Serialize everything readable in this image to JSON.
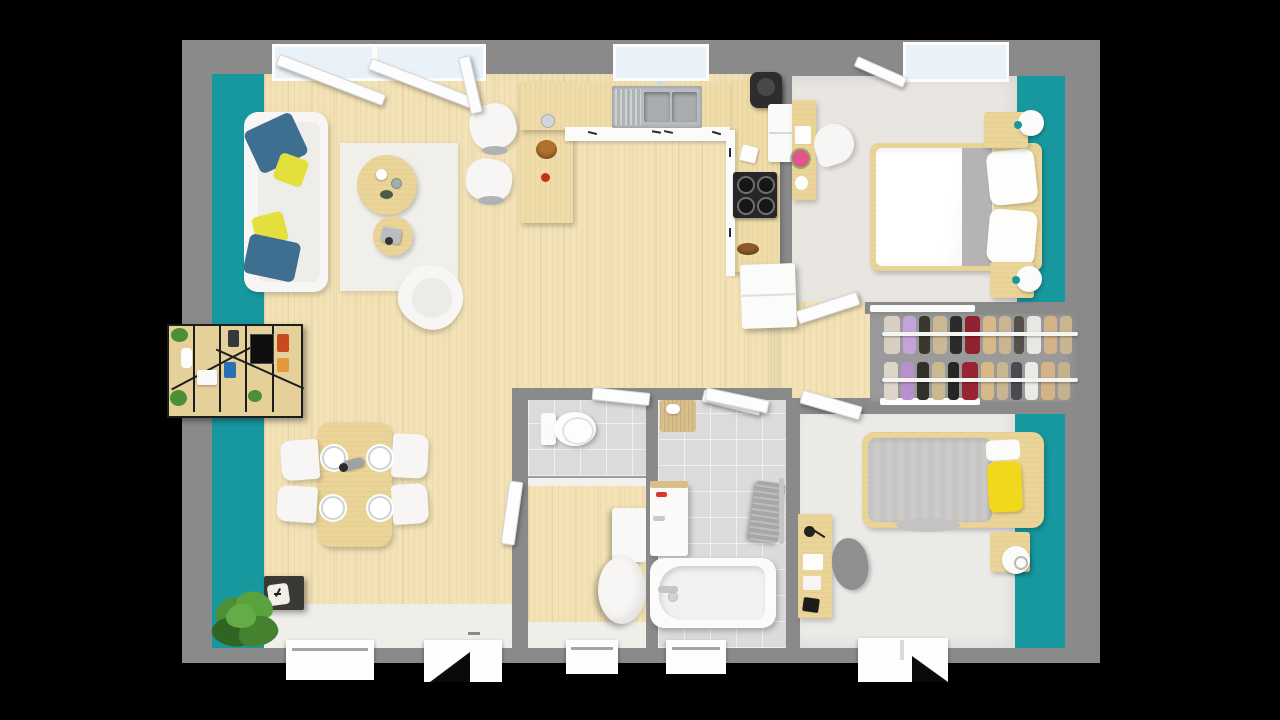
{
  "scene": {
    "type": "3d-rendered-floor-plan-top-view",
    "background": "#000000"
  },
  "palette": {
    "bg": "#000000",
    "wallGray": "#8A8A8A",
    "wallLight": "#F2F1EF",
    "teal": "#17989F",
    "woodFloor": "#F2E2B6",
    "woodCounter": "#EFDCA9",
    "woodFurn": "#EBD498",
    "whiteFurn": "#F7F6F4",
    "rug": "#F1EFEA",
    "entryFloor": "#F0EEE9",
    "bedroomFloor": "#E9E6E2",
    "bedroom2Floor": "#ECEAE7",
    "closetFloor": "#9A9A9A",
    "tile": "#DCDBDA",
    "glass": "#E9F2F8",
    "pillowBlue": "#3E6F90",
    "pillowYellow": "#E3DF3D",
    "bedPillowYellow": "#F0D91C",
    "duvetGray": "#CDCBC9",
    "blanketGray": "#B5B4B2",
    "plantGreen": "#4C8F35",
    "darkCabinet": "#3B3936",
    "applianceBlack": "#26262A",
    "steel": "#B9BDC0",
    "steelDark": "#A8ADB0",
    "towelGray": "#A6A7A9",
    "chairGray": "#8E8F91",
    "lampWhite": "#FBFBFA",
    "cakeBrown": "#B0722E",
    "flowerPink": "#E0558A"
  },
  "rooms": {
    "living_room": {
      "accent_wall": "#17989F",
      "furniture": [
        "sofa",
        "blue-pillows",
        "yellow-pillows",
        "area-rug",
        "round-coffee-table-large",
        "round-coffee-table-small",
        "armchair",
        "wall-bookshelf",
        "sideboard-with-clock",
        "potted-plant",
        "bar-stools"
      ]
    },
    "kitchen": {
      "furniture": [
        "u-shaped-counter",
        "double-sink",
        "induction-cooktop",
        "coffee-machine",
        "wall-oven",
        "refrigerator",
        "cake",
        "glass"
      ]
    },
    "dining_area": {
      "furniture": [
        "dining-table",
        "chairs-x4",
        "plates-x4",
        "pepper-mill"
      ]
    },
    "wc": {
      "furniture": [
        "toilet"
      ]
    },
    "laundry_hall": {
      "furniture": [
        "washer-box",
        "water-heater-cylinder"
      ]
    },
    "bathroom": {
      "furniture": [
        "bath-mat",
        "washing-machine",
        "towel-rail",
        "bathtub",
        "ceiling-light-bar"
      ]
    },
    "bedroom_1": {
      "accent_wall": "#17989F",
      "furniture": [
        "double-bed",
        "pillows-x2",
        "gray-runner",
        "nightstand-x2",
        "ball-lamp-x2",
        "desk",
        "desk-chair",
        "pink-flower"
      ]
    },
    "closet": {
      "furniture": [
        "clothes-rail-x2",
        "hanging-garments"
      ]
    },
    "bedroom_2": {
      "accent_wall": "#17989F",
      "furniture": [
        "single-bed",
        "yellow-pillow",
        "nightstand",
        "ball-lamp",
        "desk",
        "desk-lamp",
        "desk-chair"
      ]
    }
  },
  "openings": {
    "top_windows": [
      "living-sliding-door",
      "kitchen-window",
      "bedroom1-window"
    ],
    "bottom_windows": [
      "dining-window",
      "hall-window",
      "bathroom-window",
      "bedroom2-window"
    ],
    "doors": [
      "entry-door",
      "wc-door",
      "bathroom-door",
      "hall-door",
      "bedroom1-door",
      "bedroom2-door"
    ]
  },
  "closet_data": {
    "rails": [
      {
        "garments": [
          {
            "c": "#D8CFC3",
            "w": 16
          },
          {
            "c": "#C4A2DA",
            "w": 13
          },
          {
            "c": "#3A3630",
            "w": 11
          },
          {
            "c": "#CBB893",
            "w": 14
          },
          {
            "c": "#2B2B2B",
            "w": 12
          },
          {
            "c": "#8F2130",
            "w": 15
          },
          {
            "c": "#D8B887",
            "w": 13
          },
          {
            "c": "#C9B58F",
            "w": 12
          },
          {
            "c": "#55504C",
            "w": 10
          },
          {
            "c": "#E9E7E3",
            "w": 14
          },
          {
            "c": "#D2B286",
            "w": 13
          },
          {
            "c": "#C9B58F",
            "w": 12
          }
        ]
      },
      {
        "garments": [
          {
            "c": "#DDD5C9",
            "w": 14
          },
          {
            "c": "#B890CE",
            "w": 13
          },
          {
            "c": "#332F2B",
            "w": 12
          },
          {
            "c": "#CBB893",
            "w": 13
          },
          {
            "c": "#262626",
            "w": 11
          },
          {
            "c": "#9A2434",
            "w": 16
          },
          {
            "c": "#D8B887",
            "w": 13
          },
          {
            "c": "#C9B58F",
            "w": 11
          },
          {
            "c": "#4A4A50",
            "w": 11
          },
          {
            "c": "#ECEAE6",
            "w": 13
          },
          {
            "c": "#D2B286",
            "w": 14
          },
          {
            "c": "#C4B28C",
            "w": 12
          }
        ]
      }
    ]
  }
}
